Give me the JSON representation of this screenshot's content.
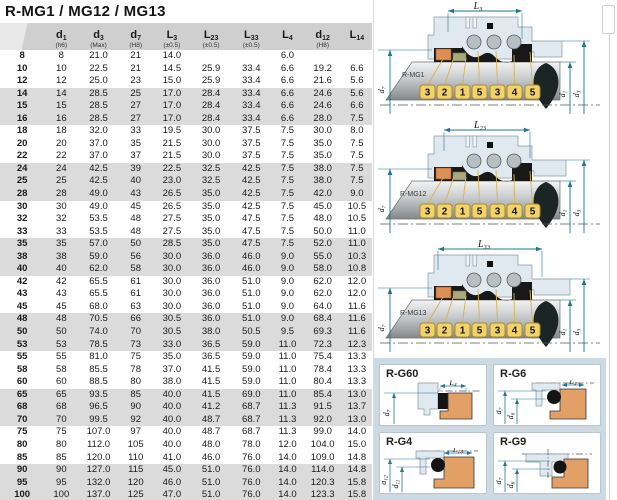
{
  "title": "R-MG1 / MG12 / MG13",
  "table": {
    "columns": [
      {
        "sym": "",
        "sub": "",
        "note": ""
      },
      {
        "sym": "d",
        "sub": "1",
        "note": "(h6)"
      },
      {
        "sym": "d",
        "sub": "3",
        "note": "(Max)"
      },
      {
        "sym": "d",
        "sub": "7",
        "note": "(H8)"
      },
      {
        "sym": "L",
        "sub": "3",
        "note": "(±0.5)"
      },
      {
        "sym": "L",
        "sub": "23",
        "note": "(±0.5)"
      },
      {
        "sym": "L",
        "sub": "33",
        "note": "(±0.5)"
      },
      {
        "sym": "L",
        "sub": "4",
        "note": ""
      },
      {
        "sym": "d",
        "sub": "12",
        "note": "(H8)"
      },
      {
        "sym": "L",
        "sub": "14",
        "note": ""
      }
    ],
    "rows": [
      [
        "8",
        "8",
        "21.0",
        "21",
        "14.0",
        "",
        "",
        "6.0",
        "",
        ""
      ],
      [
        "10",
        "10",
        "22.5",
        "21",
        "14.5",
        "25.9",
        "33.4",
        "6.6",
        "19.2",
        "6.6"
      ],
      [
        "12",
        "12",
        "25.0",
        "23",
        "15.0",
        "25.9",
        "33.4",
        "6.6",
        "21.6",
        "5.6"
      ],
      [
        "14",
        "14",
        "28.5",
        "25",
        "17.0",
        "28.4",
        "33.4",
        "6.6",
        "24.6",
        "5.6"
      ],
      [
        "15",
        "15",
        "28.5",
        "27",
        "17.0",
        "28.4",
        "33.4",
        "6.6",
        "24.6",
        "6.6"
      ],
      [
        "16",
        "16",
        "28.5",
        "27",
        "17.0",
        "28.4",
        "33.4",
        "6.6",
        "28.0",
        "7.5"
      ],
      [
        "18",
        "18",
        "32.0",
        "33",
        "19.5",
        "30.0",
        "37.5",
        "7.5",
        "30.0",
        "8.0"
      ],
      [
        "20",
        "20",
        "37.0",
        "35",
        "21.5",
        "30.0",
        "37.5",
        "7.5",
        "35.0",
        "7.5"
      ],
      [
        "22",
        "22",
        "37.0",
        "37",
        "21.5",
        "30.0",
        "37.5",
        "7.5",
        "35.0",
        "7.5"
      ],
      [
        "24",
        "24",
        "42.5",
        "39",
        "22.5",
        "32.5",
        "42.5",
        "7.5",
        "38.0",
        "7.5"
      ],
      [
        "25",
        "25",
        "42.5",
        "40",
        "23.0",
        "32.5",
        "42.5",
        "7.5",
        "38.0",
        "7.5"
      ],
      [
        "28",
        "28",
        "49.0",
        "43",
        "26.5",
        "35.0",
        "42.5",
        "7.5",
        "42.0",
        "9.0"
      ],
      [
        "30",
        "30",
        "49.0",
        "45",
        "26.5",
        "35.0",
        "42.5",
        "7.5",
        "45.0",
        "10.5"
      ],
      [
        "32",
        "32",
        "53.5",
        "48",
        "27.5",
        "35.0",
        "47.5",
        "7.5",
        "48.0",
        "10.5"
      ],
      [
        "33",
        "33",
        "53.5",
        "48",
        "27.5",
        "35.0",
        "47.5",
        "7.5",
        "50.0",
        "11.0"
      ],
      [
        "35",
        "35",
        "57.0",
        "50",
        "28.5",
        "35.0",
        "47.5",
        "7.5",
        "52.0",
        "11.0"
      ],
      [
        "38",
        "38",
        "59.0",
        "56",
        "30.0",
        "36.0",
        "46.0",
        "9.0",
        "55.0",
        "10.3"
      ],
      [
        "40",
        "40",
        "62.0",
        "58",
        "30.0",
        "36.0",
        "46.0",
        "9.0",
        "58.0",
        "10.8"
      ],
      [
        "42",
        "42",
        "65.5",
        "61",
        "30.0",
        "36.0",
        "51.0",
        "9.0",
        "62.0",
        "12.0"
      ],
      [
        "43",
        "43",
        "65.5",
        "61",
        "30.0",
        "36.0",
        "51.0",
        "9.0",
        "62.0",
        "12.0"
      ],
      [
        "45",
        "45",
        "68.0",
        "63",
        "30.0",
        "36.0",
        "51.0",
        "9.0",
        "64.0",
        "11.6"
      ],
      [
        "48",
        "48",
        "70.5",
        "66",
        "30.5",
        "36.0",
        "51.0",
        "9.0",
        "68.4",
        "11.6"
      ],
      [
        "50",
        "50",
        "74.0",
        "70",
        "30.5",
        "38.0",
        "50.5",
        "9.5",
        "69.3",
        "11.6"
      ],
      [
        "53",
        "53",
        "78.5",
        "73",
        "33.0",
        "36.5",
        "59.0",
        "11.0",
        "72.3",
        "12.3"
      ],
      [
        "55",
        "55",
        "81.0",
        "75",
        "35.0",
        "36.5",
        "59.0",
        "11.0",
        "75.4",
        "13.3"
      ],
      [
        "58",
        "58",
        "85.5",
        "78",
        "37.0",
        "41.5",
        "59.0",
        "11.0",
        "78.4",
        "13.3"
      ],
      [
        "60",
        "60",
        "88.5",
        "80",
        "38.0",
        "41.5",
        "59.0",
        "11.0",
        "80.4",
        "13.3"
      ],
      [
        "65",
        "65",
        "93.5",
        "85",
        "40.0",
        "41.5",
        "69.0",
        "11.0",
        "85.4",
        "13.0"
      ],
      [
        "68",
        "68",
        "96.5",
        "90",
        "40.0",
        "41.2",
        "68.7",
        "11.3",
        "91.5",
        "13.7"
      ],
      [
        "70",
        "70",
        "99.5",
        "92",
        "40.0",
        "48.7",
        "68.7",
        "11.3",
        "92.0",
        "13.0"
      ],
      [
        "75",
        "75",
        "107.0",
        "97",
        "40.0",
        "48.7",
        "68.7",
        "11.3",
        "99.0",
        "14.0"
      ],
      [
        "80",
        "80",
        "112.0",
        "105",
        "40.0",
        "48.0",
        "78.0",
        "12.0",
        "104.0",
        "15.0"
      ],
      [
        "85",
        "85",
        "120.0",
        "110",
        "41.0",
        "46.0",
        "76.0",
        "14.0",
        "109.0",
        "14.8"
      ],
      [
        "90",
        "90",
        "127.0",
        "115",
        "45.0",
        "51.0",
        "76.0",
        "14.0",
        "114.0",
        "14.8"
      ],
      [
        "95",
        "95",
        "132.0",
        "120",
        "46.0",
        "51.0",
        "76.0",
        "14.0",
        "120.3",
        "15.8"
      ],
      [
        "100",
        "100",
        "137.0",
        "125",
        "47.0",
        "51.0",
        "76.0",
        "14.0",
        "123.3",
        "15.8"
      ]
    ]
  },
  "diagrams": [
    {
      "label": "R-MG1",
      "top_dim": {
        "sym": "L",
        "sub": "3"
      },
      "left_dim": {
        "sym": "d",
        "sub": "7"
      },
      "right_dim_inner": {
        "sym": "d",
        "sub": "1"
      },
      "right_dim_outer": {
        "sym": "d",
        "sub": "3"
      },
      "callouts": [
        "3",
        "2",
        "1",
        "5",
        "3",
        "4",
        "5"
      ]
    },
    {
      "label": "R-MG12",
      "top_dim": {
        "sym": "L",
        "sub": "23"
      },
      "left_dim": {
        "sym": "d",
        "sub": "7"
      },
      "right_dim_inner": {
        "sym": "d",
        "sub": "1"
      },
      "right_dim_outer": {
        "sym": "d",
        "sub": "3"
      },
      "callouts": [
        "3",
        "2",
        "1",
        "5",
        "3",
        "4",
        "5"
      ]
    },
    {
      "label": "R-MG13",
      "top_dim": {
        "sym": "L",
        "sub": "33"
      },
      "left_dim": {
        "sym": "d",
        "sub": "7"
      },
      "right_dim_inner": {
        "sym": "d",
        "sub": "1"
      },
      "right_dim_outer": {
        "sym": "d",
        "sub": "3"
      },
      "callouts": [
        "3",
        "2",
        "1",
        "5",
        "3",
        "4",
        "5"
      ]
    }
  ],
  "seats": [
    {
      "label": "R-G60",
      "top_dim": {
        "sym": "L",
        "sub": "4"
      },
      "dims": [
        {
          "sym": "d",
          "sub": "7"
        }
      ]
    },
    {
      "label": "R-G6",
      "top_dim": {
        "sym": "L",
        "sub": "4"
      },
      "dims": [
        {
          "sym": "d",
          "sub": "7"
        },
        {
          "sym": "d",
          "sub": "6"
        }
      ]
    },
    {
      "label": "R-G4",
      "top_dim": {
        "sym": "L",
        "sub": "14"
      },
      "dims": [
        {
          "sym": "d",
          "sub": "12"
        },
        {
          "sym": "d",
          "sub": "11"
        }
      ]
    },
    {
      "label": "R-G9",
      "dims": [
        {
          "sym": "d",
          "sub": "7"
        },
        {
          "sym": "d",
          "sub": "6"
        }
      ]
    }
  ],
  "colors": {
    "header_gray": "#cfcfcf",
    "stripe_gray": "#dbdbdb",
    "dimension_teal": "#1f7591",
    "callout_yellow": "#f2d36b",
    "housing_blue": "#dfe9ef",
    "seat_tan": "#e2a066",
    "oring_black": "#141414",
    "panel_blue": "#cdd9e3",
    "orange_part": "#dd8f55",
    "olive_part": "#a9a97d"
  }
}
